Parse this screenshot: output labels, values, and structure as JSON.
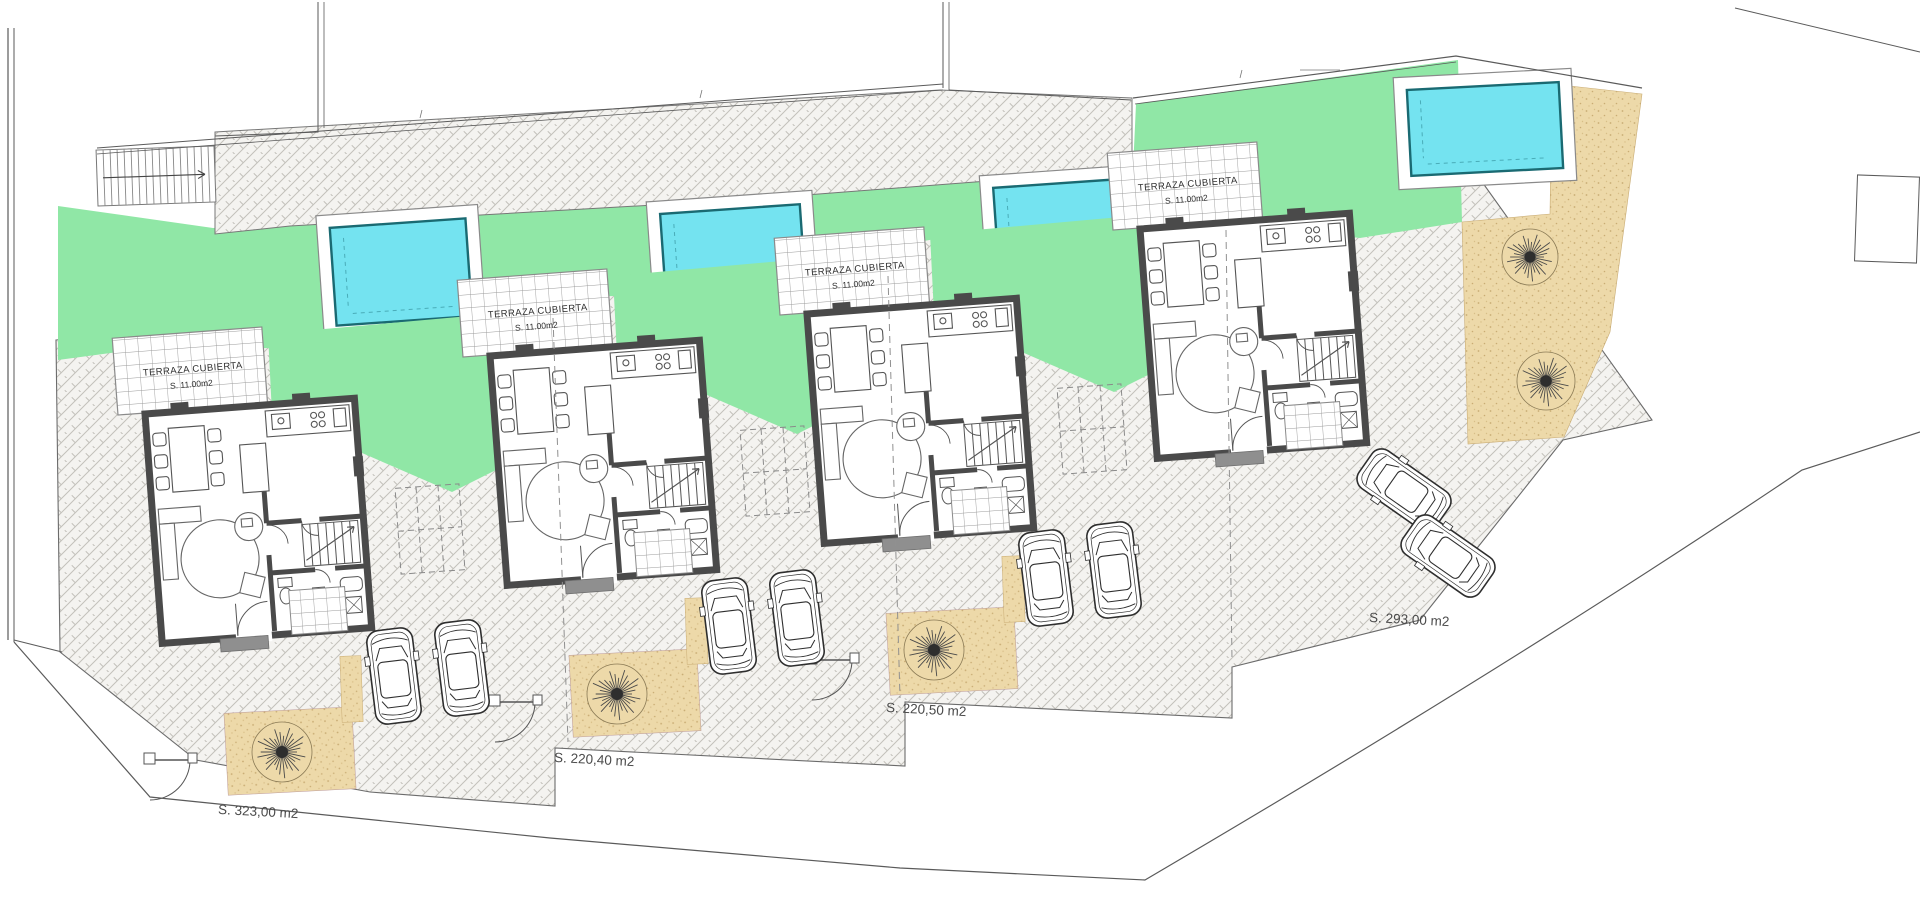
{
  "title": "Residential site plan - 4 villas",
  "terrace": {
    "label": "TERRAZA CUBIERTA",
    "area": "S. 11.00m2"
  },
  "units": [
    {
      "name": "villa-1",
      "dx": 0,
      "dy": 0,
      "plot_area": "S. 323,00 m2",
      "label_x": 258,
      "label_y": 816,
      "front": true
    },
    {
      "name": "villa-2",
      "dx": 345,
      "dy": -58,
      "plot_area": "S. 220,40 m2",
      "label_x": 594,
      "label_y": 764,
      "front": true
    },
    {
      "name": "villa-3",
      "dx": 662,
      "dy": -100,
      "plot_area": "S. 220,50 m2",
      "label_x": 926,
      "label_y": 714,
      "front": true
    },
    {
      "name": "villa-4",
      "dx": 995,
      "dy": -185,
      "plot_area": "S. 293,00 m2",
      "label_x": 1409,
      "label_y": 624,
      "front": false
    }
  ],
  "pools": [
    {
      "x": 320,
      "y": 210,
      "w": 162,
      "h": 124,
      "rot": -4
    },
    {
      "x": 650,
      "y": 196,
      "w": 166,
      "h": 114,
      "rot": -4
    },
    {
      "x": 983,
      "y": 170,
      "w": 164,
      "h": 112,
      "rot": -4
    },
    {
      "x": 1396,
      "y": 73,
      "w": 178,
      "h": 112,
      "rot": -3
    }
  ],
  "cars": [
    {
      "x": 394,
      "y": 676,
      "r": -7
    },
    {
      "x": 462,
      "y": 668,
      "r": -7
    },
    {
      "x": 729,
      "y": 626,
      "r": -7
    },
    {
      "x": 797,
      "y": 618,
      "r": -7
    },
    {
      "x": 1046,
      "y": 578,
      "r": -7
    },
    {
      "x": 1114,
      "y": 570,
      "r": -7
    },
    {
      "x": 1404,
      "y": 490,
      "r": -55
    },
    {
      "x": 1448,
      "y": 556,
      "r": -55
    }
  ],
  "trees": [
    {
      "x": 282,
      "y": 752,
      "r": 30
    },
    {
      "x": 617,
      "y": 694,
      "r": 30
    },
    {
      "x": 934,
      "y": 650,
      "r": 30
    },
    {
      "x": 1530,
      "y": 257,
      "r": 28
    },
    {
      "x": 1546,
      "y": 381,
      "r": 29
    }
  ],
  "colors": {
    "lawn": "#90E7A6",
    "pool": "#74E3F0",
    "pool_border": "#1A6A72",
    "sand": "#EDD9A9",
    "sand_dot": "#C9AC74",
    "wall": "#4A4A4A",
    "paving_bg": "#F4F3F0",
    "paving_line": "#BFBDB8",
    "grid_line": "#9B9B9B",
    "boundary": "#5A5A5A",
    "dash": "#8A8A8A",
    "car": "#2E2E2E",
    "text": "#3A3A3A"
  }
}
